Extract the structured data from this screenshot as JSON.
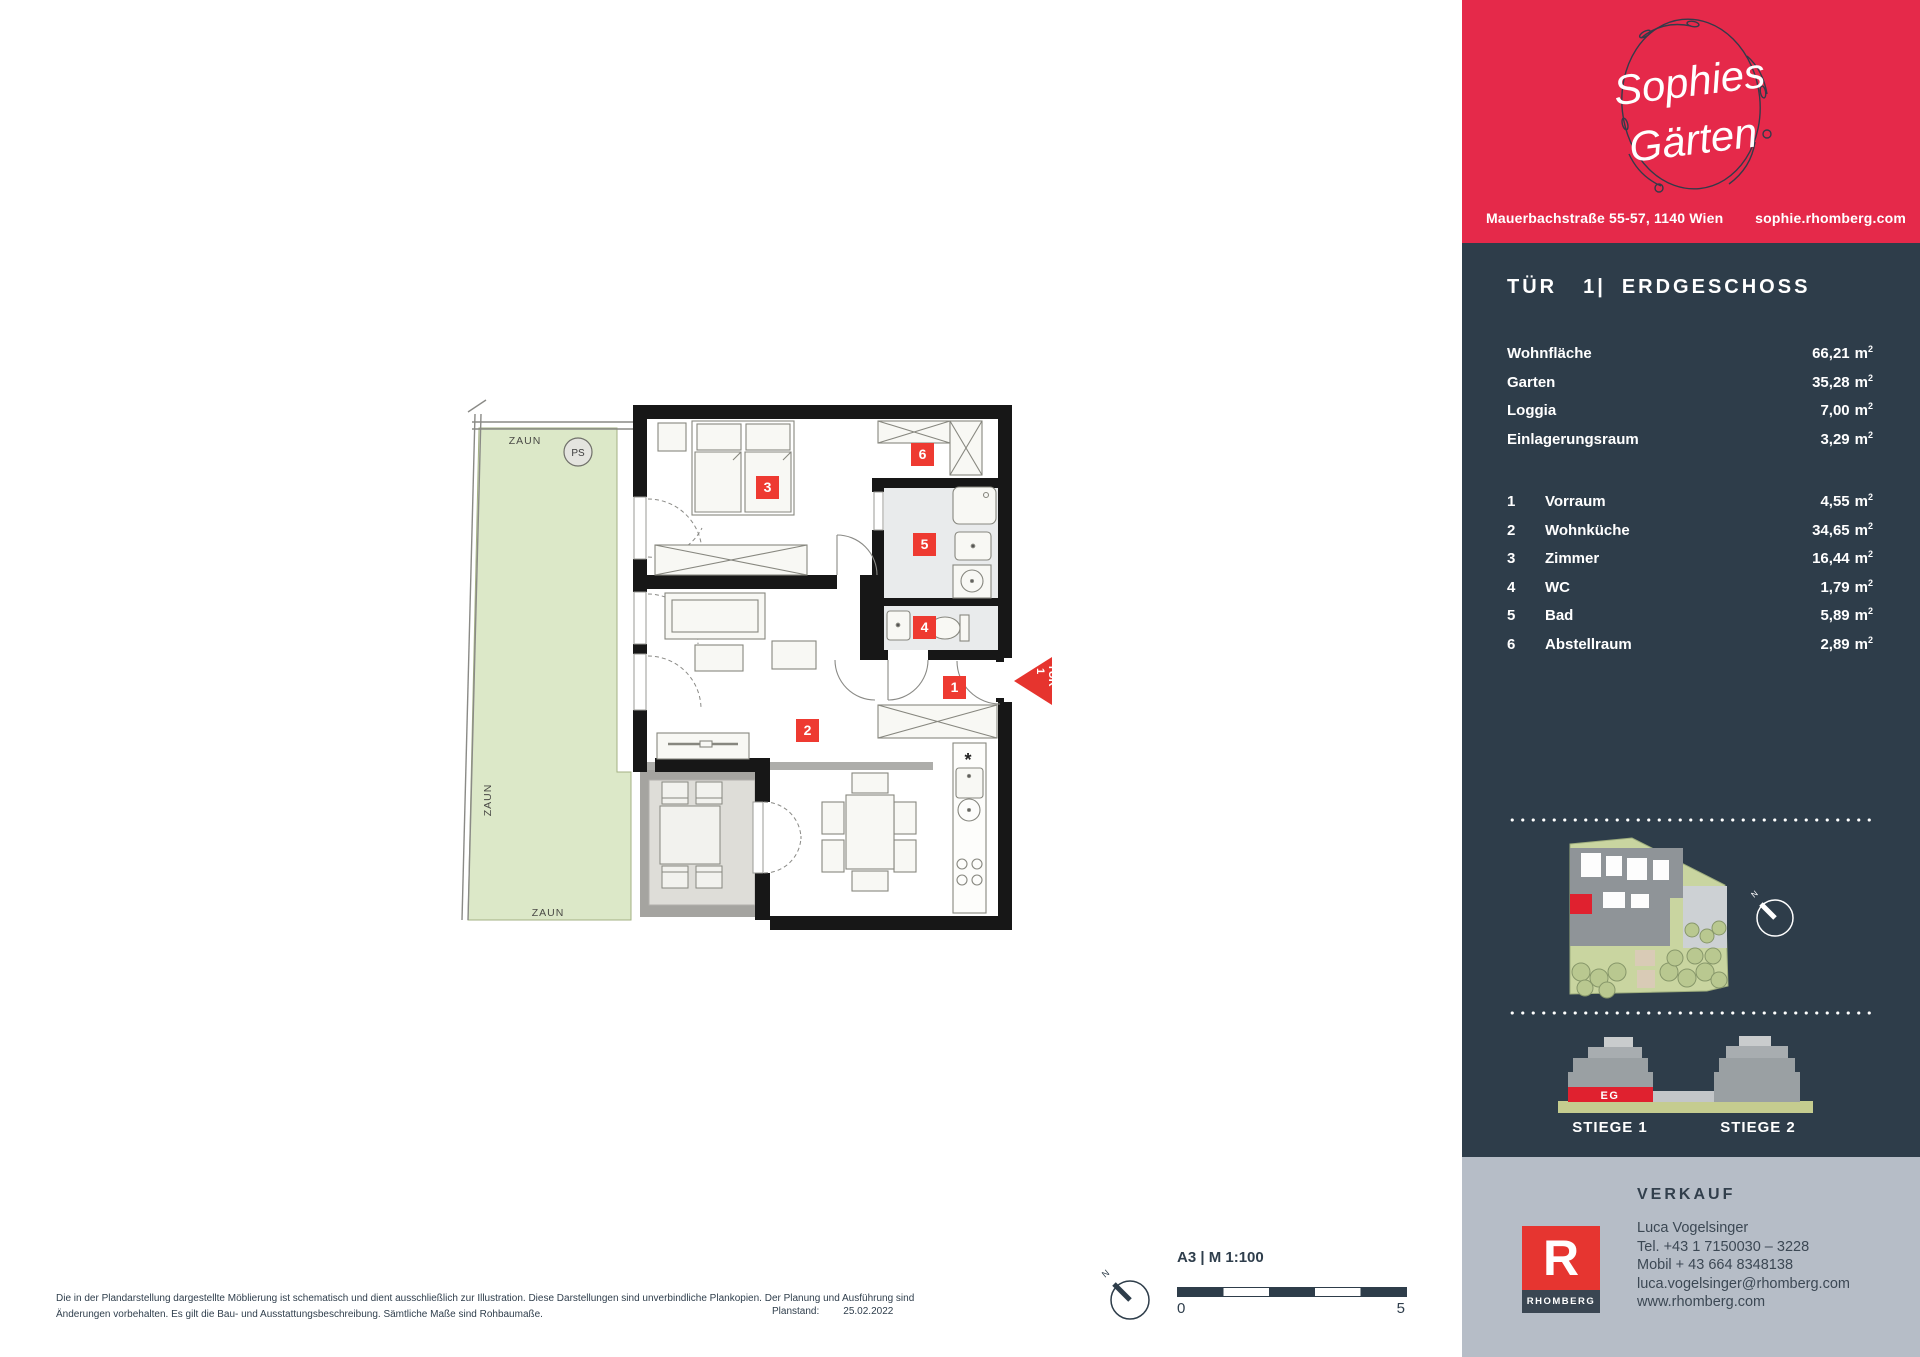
{
  "colors": {
    "brand_red": "#e5294a",
    "panel_navy": "#2e3d4a",
    "badge_red": "#ee3a31",
    "footer_gray": "#b6bdc7",
    "rhomberg_red": "#e63530",
    "garden_green": "#dce8c8",
    "site_green": "#c9d5a0"
  },
  "header": {
    "brand_line1": "Sophies",
    "brand_line2": "Gärten",
    "address": "Mauerbachstraße 55-57, 1140 Wien",
    "website": "sophie.rhomberg.com"
  },
  "unit": {
    "door_label": "TÜR",
    "door_number": "1|",
    "floor_label": "ERDGESCHOSS"
  },
  "areas": [
    {
      "label": "Wohnfläche",
      "value": "66,21",
      "unit": "m",
      "unit_sup": "2"
    },
    {
      "label": "Garten",
      "value": "35,28",
      "unit": "m",
      "unit_sup": "2"
    },
    {
      "label": "Loggia",
      "value": "7,00",
      "unit": "m",
      "unit_sup": "2"
    },
    {
      "label": "Einlagerungsraum",
      "value": "3,29",
      "unit": "m",
      "unit_sup": "2"
    }
  ],
  "rooms": [
    {
      "num": "1",
      "label": "Vorraum",
      "value": "4,55",
      "unit": "m",
      "unit_sup": "2"
    },
    {
      "num": "2",
      "label": "Wohnküche",
      "value": "34,65",
      "unit": "m",
      "unit_sup": "2"
    },
    {
      "num": "3",
      "label": "Zimmer",
      "value": "16,44",
      "unit": "m",
      "unit_sup": "2"
    },
    {
      "num": "4",
      "label": "WC",
      "value": "1,79",
      "unit": "m",
      "unit_sup": "2"
    },
    {
      "num": "5",
      "label": "Bad",
      "value": "5,89",
      "unit": "m",
      "unit_sup": "2"
    },
    {
      "num": "6",
      "label": "Abstellraum",
      "value": "2,89",
      "unit": "m",
      "unit_sup": "2"
    }
  ],
  "site_map": {
    "north_label": "N"
  },
  "elevation": {
    "eg_label": "EG",
    "stiege1_label": "STIEGE 1",
    "stiege2_label": "STIEGE 2"
  },
  "sales": {
    "heading": "VERKAUF",
    "name": "Luca Vogelsinger",
    "phone": "Tel. +43 1 7150030 – 3228",
    "mobile": "Mobil + 43 664 8348138",
    "email": "luca.vogelsinger@rhomberg.com",
    "website": "www.rhomberg.com",
    "logo_letter": "R",
    "logo_name": "RHOMBERG"
  },
  "plan": {
    "zaun_top": "ZAUN",
    "zaun_left": "ZAUN",
    "zaun_bottom": "ZAUN",
    "ps_label": "PS",
    "badges": [
      "1",
      "2",
      "3",
      "4",
      "5",
      "6"
    ],
    "entrance_number": "1",
    "entrance_label": "TÜR",
    "kitchen_marker": "*",
    "north_label": "N"
  },
  "footer_plan": {
    "disclaimer_line1": "Die in der Plandarstellung dargestellte Möblierung ist schematisch und dient ausschließlich zur Illustration. Diese Darstellungen sind unverbindliche Plankopien. Der Planung und Ausführung sind",
    "disclaimer_line2": "Änderungen vorbehalten. Es gilt die Bau- und Ausstattungsbeschreibung. Sämtliche Maße sind Rohbaumaße.",
    "planstand_label": "Planstand:",
    "planstand_value": "25.02.2022",
    "scale_label": "A3 | M 1:100",
    "scale_start": "0",
    "scale_end": "5"
  }
}
